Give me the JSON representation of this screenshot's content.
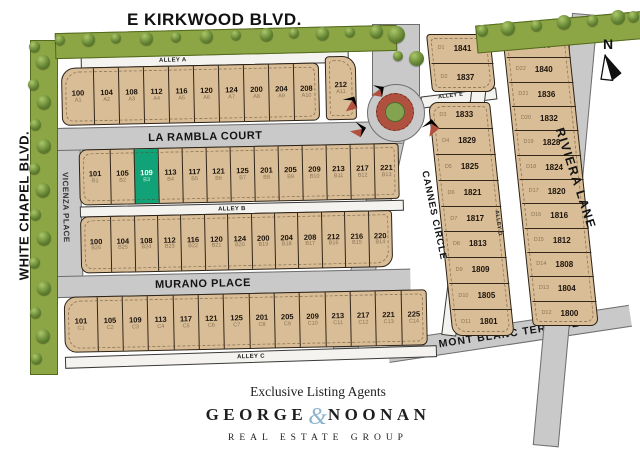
{
  "streets": {
    "kirkwood": "E KIRKWOOD BLVD.",
    "white_chapel": "WHITE CHAPEL BLVD.",
    "vicenza": "VICENZA PLACE",
    "la_rambla": "LA RAMBLA COURT",
    "murano": "MURANO PLACE",
    "cannes": "CANNES CIRCLE",
    "mont_blanc": "MONT BLANC TERRACE",
    "riviera": "RIVIERA LANE",
    "alley_a": "ALLEY A",
    "alley_b": "ALLEY B",
    "alley_c": "ALLEY C",
    "alley_d": "ALLEY D",
    "alley_e": "ALLEY E"
  },
  "compass": {
    "label": "N"
  },
  "lots": {
    "rowA": [
      {
        "num": "100",
        "code": "A1"
      },
      {
        "num": "104",
        "code": "A2"
      },
      {
        "num": "108",
        "code": "A3"
      },
      {
        "num": "112",
        "code": "A4"
      },
      {
        "num": "116",
        "code": "A5"
      },
      {
        "num": "120",
        "code": "A6"
      },
      {
        "num": "124",
        "code": "A7"
      },
      {
        "num": "200",
        "code": "A8"
      },
      {
        "num": "204",
        "code": "A9"
      },
      {
        "num": "208",
        "code": "A10"
      }
    ],
    "rowA_end": [
      {
        "num": "212",
        "code": "A11"
      }
    ],
    "rowB_upper": [
      {
        "num": "101",
        "code": "B1"
      },
      {
        "num": "105",
        "code": "B2"
      },
      {
        "num": "109",
        "code": "B3",
        "hl": true
      },
      {
        "num": "113",
        "code": "B4"
      },
      {
        "num": "117",
        "code": "B5"
      },
      {
        "num": "121",
        "code": "B6"
      },
      {
        "num": "125",
        "code": "B7"
      },
      {
        "num": "201",
        "code": "B8"
      },
      {
        "num": "205",
        "code": "B9"
      },
      {
        "num": "209",
        "code": "B10"
      },
      {
        "num": "213",
        "code": "B11"
      },
      {
        "num": "217",
        "code": "B12"
      },
      {
        "num": "221",
        "code": "B13"
      }
    ],
    "rowB_lower": [
      {
        "num": "100",
        "code": "B26"
      },
      {
        "num": "104",
        "code": "B25"
      },
      {
        "num": "108",
        "code": "B24"
      },
      {
        "num": "112",
        "code": "B23"
      },
      {
        "num": "116",
        "code": "B22"
      },
      {
        "num": "120",
        "code": "B21"
      },
      {
        "num": "124",
        "code": "B20"
      },
      {
        "num": "200",
        "code": "B19"
      },
      {
        "num": "204",
        "code": "B18"
      },
      {
        "num": "208",
        "code": "B17"
      },
      {
        "num": "212",
        "code": "B16"
      },
      {
        "num": "216",
        "code": "B15"
      },
      {
        "num": "220",
        "code": "B14"
      }
    ],
    "rowC": [
      {
        "num": "101",
        "code": "C1"
      },
      {
        "num": "105",
        "code": "C2"
      },
      {
        "num": "109",
        "code": "C3"
      },
      {
        "num": "113",
        "code": "C4"
      },
      {
        "num": "117",
        "code": "C5"
      },
      {
        "num": "121",
        "code": "C6"
      },
      {
        "num": "125",
        "code": "C7"
      },
      {
        "num": "201",
        "code": "C8"
      },
      {
        "num": "205",
        "code": "C9"
      },
      {
        "num": "209",
        "code": "C10"
      },
      {
        "num": "213",
        "code": "C11"
      },
      {
        "num": "217",
        "code": "C12"
      },
      {
        "num": "221",
        "code": "C13"
      },
      {
        "num": "225",
        "code": "C14"
      }
    ],
    "d_top": [
      {
        "code": "D1",
        "num": "1841"
      },
      {
        "code": "D2",
        "num": "1837"
      }
    ],
    "d_left": [
      {
        "code": "D3",
        "num": "1833"
      },
      {
        "code": "D4",
        "num": "1829"
      },
      {
        "code": "D5",
        "num": "1825"
      },
      {
        "code": "D6",
        "num": "1821"
      },
      {
        "code": "D7",
        "num": "1817"
      },
      {
        "code": "D8",
        "num": "1813"
      },
      {
        "code": "D9",
        "num": "1809"
      },
      {
        "code": "D10",
        "num": "1805"
      },
      {
        "code": "D11",
        "num": "1801"
      }
    ],
    "d_right": [
      {
        "code": "D23",
        "num": "1844"
      },
      {
        "code": "D22",
        "num": "1840"
      },
      {
        "code": "D21",
        "num": "1836"
      },
      {
        "code": "D20",
        "num": "1832"
      },
      {
        "code": "D19",
        "num": "1828"
      },
      {
        "code": "D18",
        "num": "1824"
      },
      {
        "code": "D17",
        "num": "1820"
      },
      {
        "code": "D16",
        "num": "1816"
      },
      {
        "code": "D15",
        "num": "1812"
      },
      {
        "code": "D14",
        "num": "1808"
      },
      {
        "code": "D13",
        "num": "1804"
      },
      {
        "code": "D12",
        "num": "1800"
      }
    ]
  },
  "branding": {
    "tagline": "Exclusive Listing Agents",
    "name_first": "GEORGE",
    "ampersand": "&",
    "name_last": "NOONAN",
    "subtitle": "REAL ESTATE GROUP"
  },
  "colors": {
    "lot_fill": "#d8bd97",
    "highlight_lot": "#12a277",
    "street": "#c9c9c9",
    "tree_strip": "#8ca545",
    "roundabout_ring": "#b05140",
    "roundabout_center": "#84a351",
    "ampersand": "#8db3cf"
  }
}
